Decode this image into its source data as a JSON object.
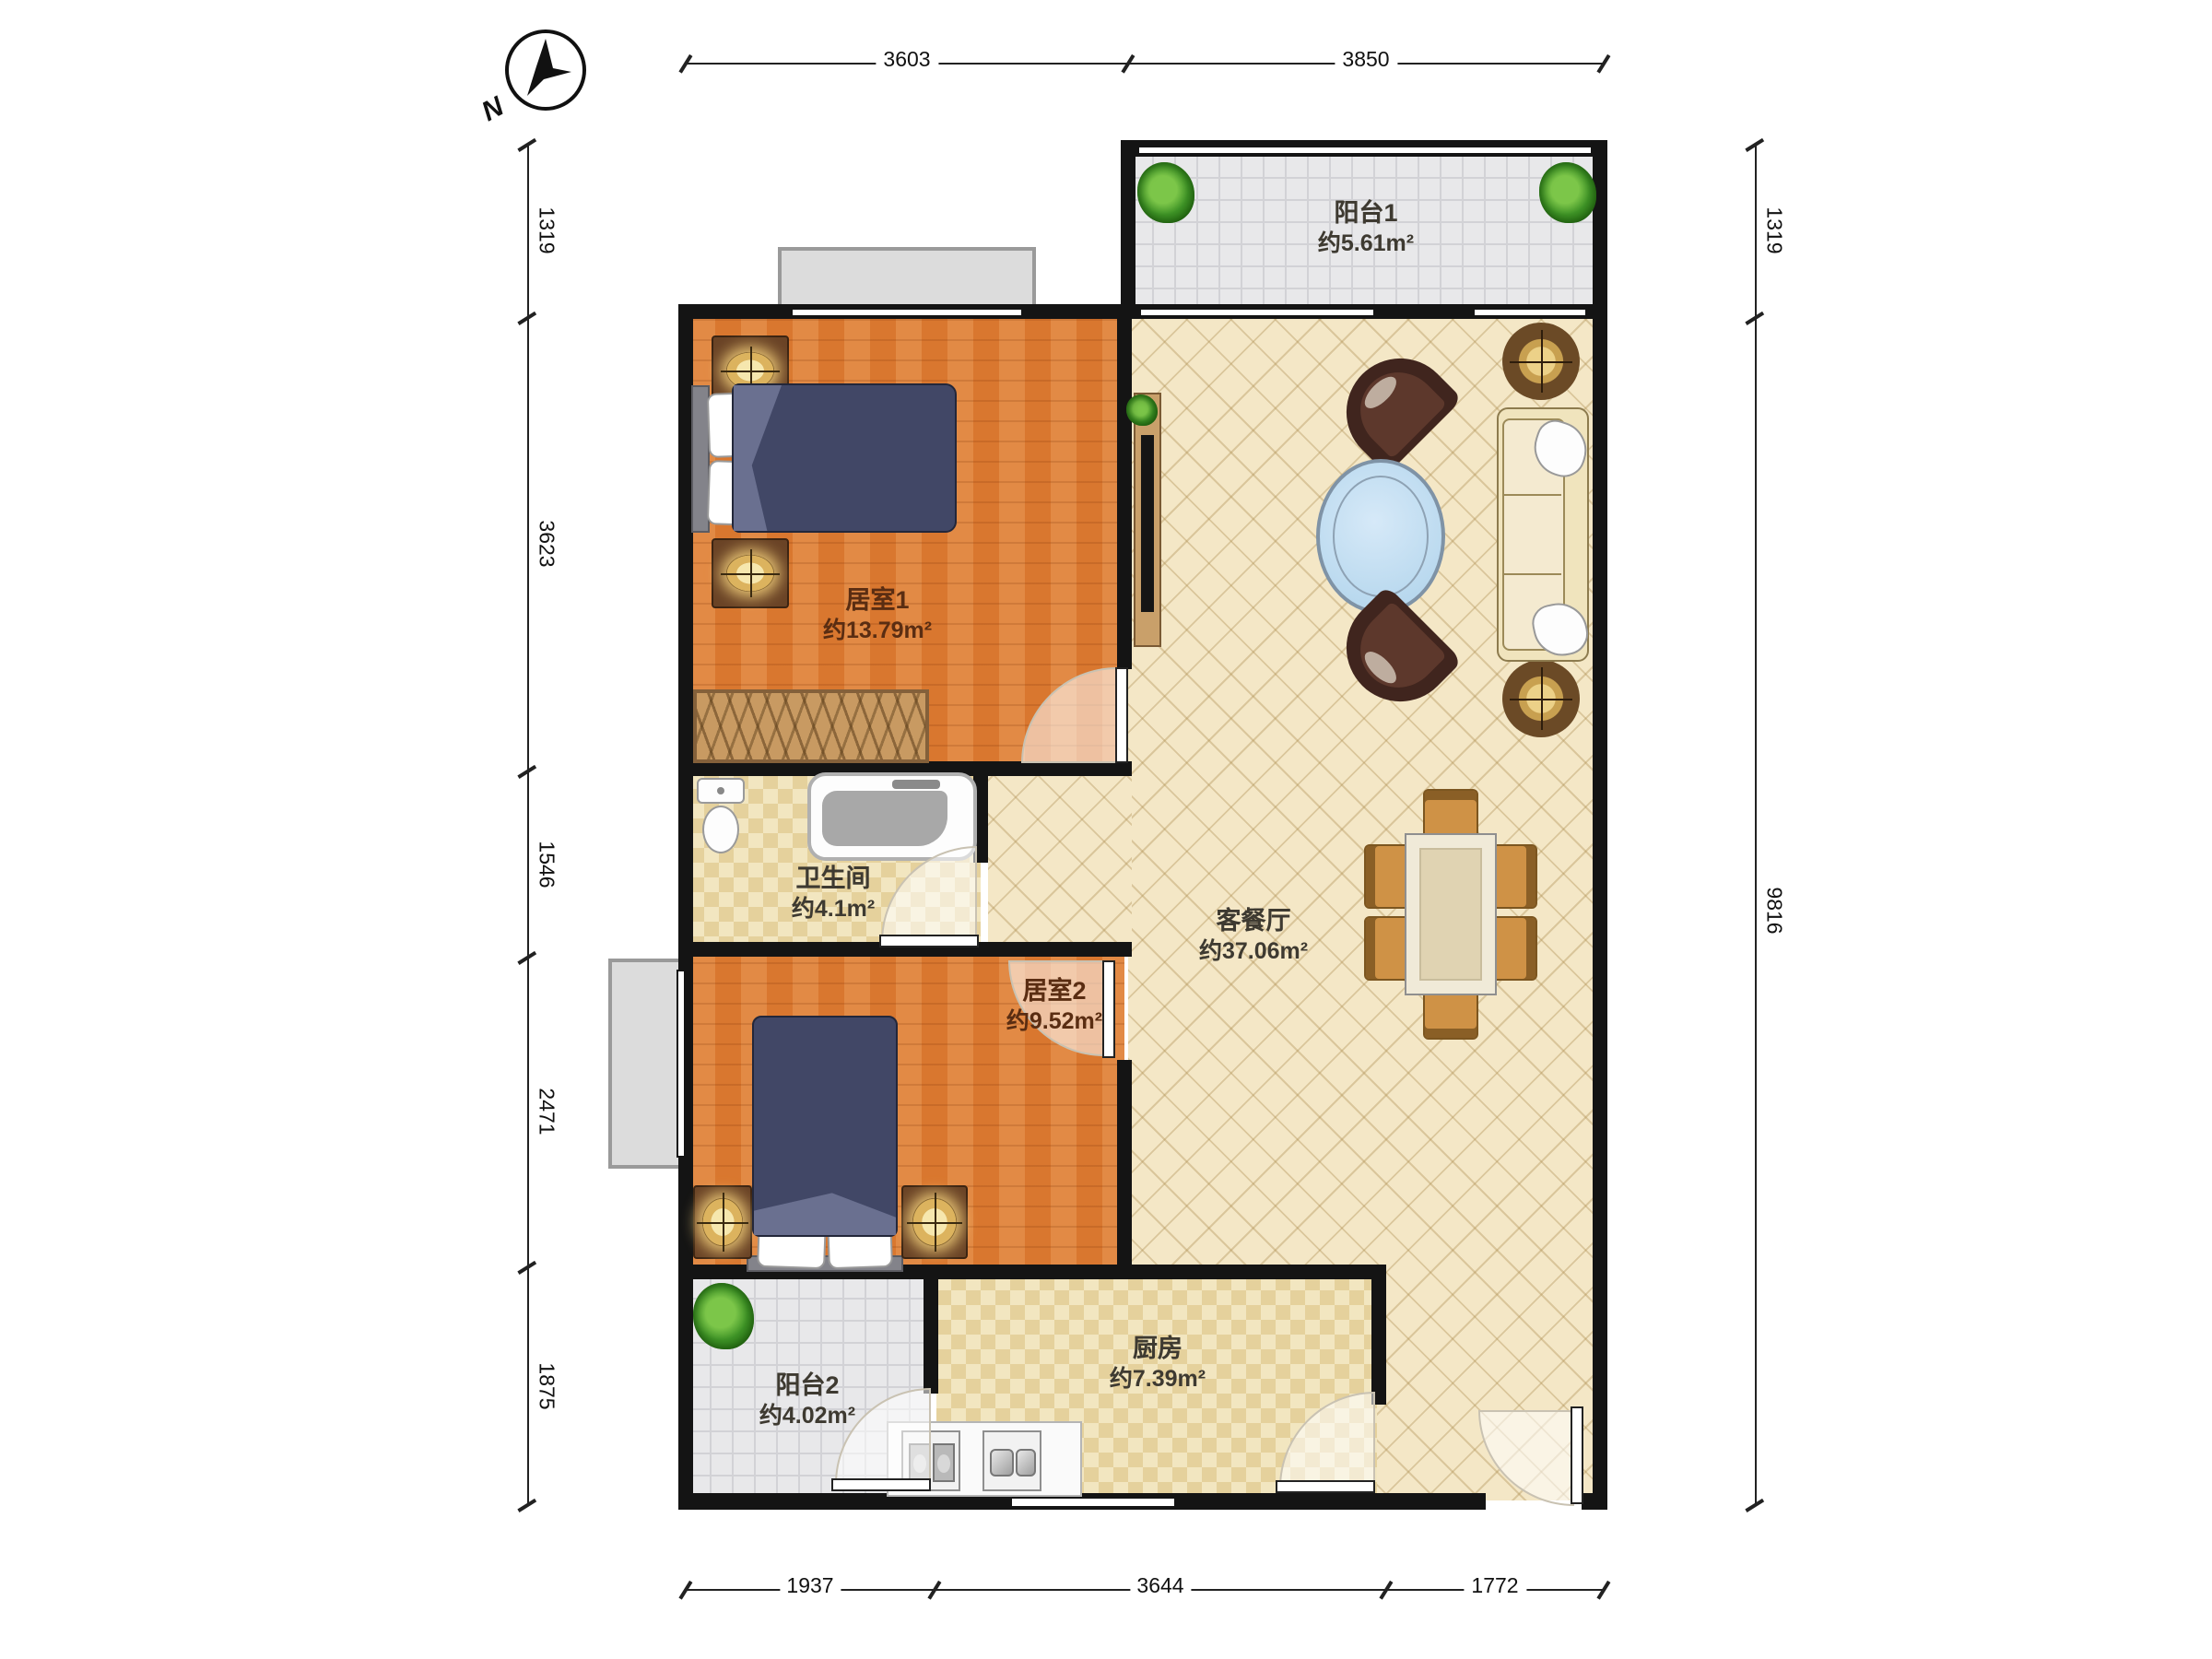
{
  "compass": {
    "label": "N"
  },
  "rooms": [
    {
      "id": "balcony1",
      "name": "阳台1",
      "area": "约5.61m²"
    },
    {
      "id": "bedroom1",
      "name": "居室1",
      "area": "约13.79m²"
    },
    {
      "id": "living_dining",
      "name": "客餐厅",
      "area": "约37.06m²"
    },
    {
      "id": "bathroom",
      "name": "卫生间",
      "area": "约4.1m²"
    },
    {
      "id": "bedroom2",
      "name": "居室2",
      "area": "约9.52m²"
    },
    {
      "id": "balcony2",
      "name": "阳台2",
      "area": "约4.02m²"
    },
    {
      "id": "kitchen",
      "name": "厨房",
      "area": "约7.39m²"
    }
  ],
  "dimensions": {
    "top": [
      "3603",
      "3850"
    ],
    "left": [
      "1319",
      "3623",
      "1546",
      "2471",
      "1875"
    ],
    "right": [
      "1319",
      "9816"
    ],
    "bottom": [
      "1937",
      "3644",
      "1772"
    ]
  },
  "palette": {
    "wall": "#141414",
    "wood_floor": "#e0853f",
    "tile_floor": "#f4e7c6",
    "checker_floor": "#efe1ba",
    "balcony_floor": "#e8e8ea",
    "duvet": "#414766",
    "accent_wood": "#c89a62"
  },
  "furniture_icons": [
    "double-bed",
    "single-bed",
    "nightstand-lamp",
    "wardrobe",
    "toilet",
    "bathtub",
    "sofa",
    "armchair",
    "coffee-table",
    "dining-table",
    "dining-chair",
    "tv-cabinet",
    "potted-plant",
    "kitchen-sink",
    "stove",
    "floor-planter"
  ]
}
